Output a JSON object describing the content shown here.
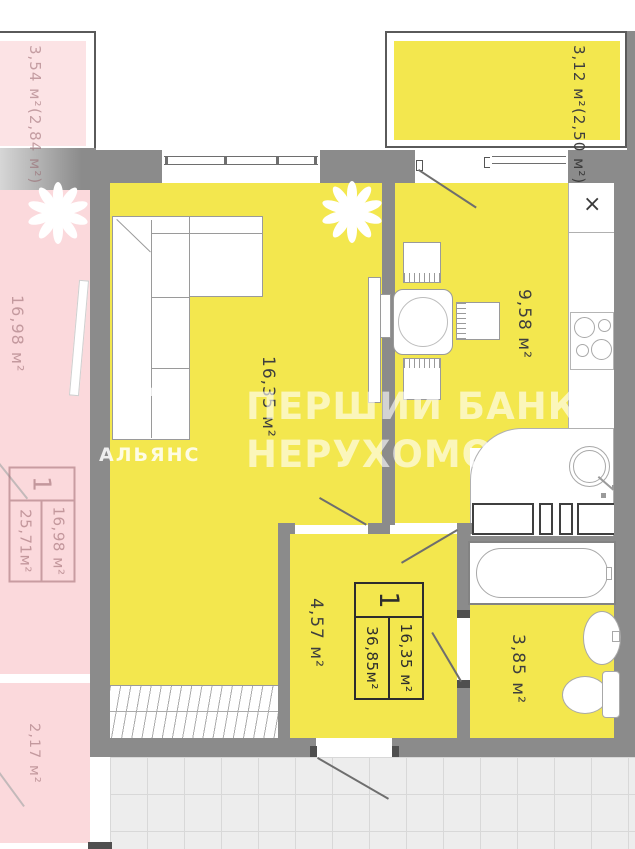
{
  "watermark": {
    "line1": "ПЕРШИЙ БАНК",
    "line2": "НЕРУХОМОСТІ",
    "logo_glyph": "Л",
    "logo_text": "АЛЬЯНС"
  },
  "apartment": {
    "living_room_area": "16,35 м²",
    "kitchen_area": "9,58 м²",
    "hallway_area": "4,57 м²",
    "bathroom_area": "3,85 м²",
    "balcony_area": "3,12 м²",
    "balcony_area_reduced": "(2,50 м²)",
    "kitchen_sink_mark": "×",
    "stamp": {
      "number": "1",
      "living_area": "16,35 м²",
      "total_area": "36,85м²"
    }
  },
  "neighbor_apartment": {
    "balcony_area": "3,54 м²",
    "balcony_area_reduced": "(2,84 м²)",
    "room_area": "16,98 м²",
    "small_balcony_area": "2,17 м²",
    "stamp": {
      "number": "1",
      "living_area": "16,98 м²",
      "total_area": "25,71м²"
    }
  },
  "colors": {
    "room_fill": "#f3e74e",
    "neighbor_fill": "#fbd9dc",
    "wall": "#8b8b8b",
    "corridor_tile": "#ededed",
    "watermark": "rgba(255,255,255,0.62)"
  }
}
